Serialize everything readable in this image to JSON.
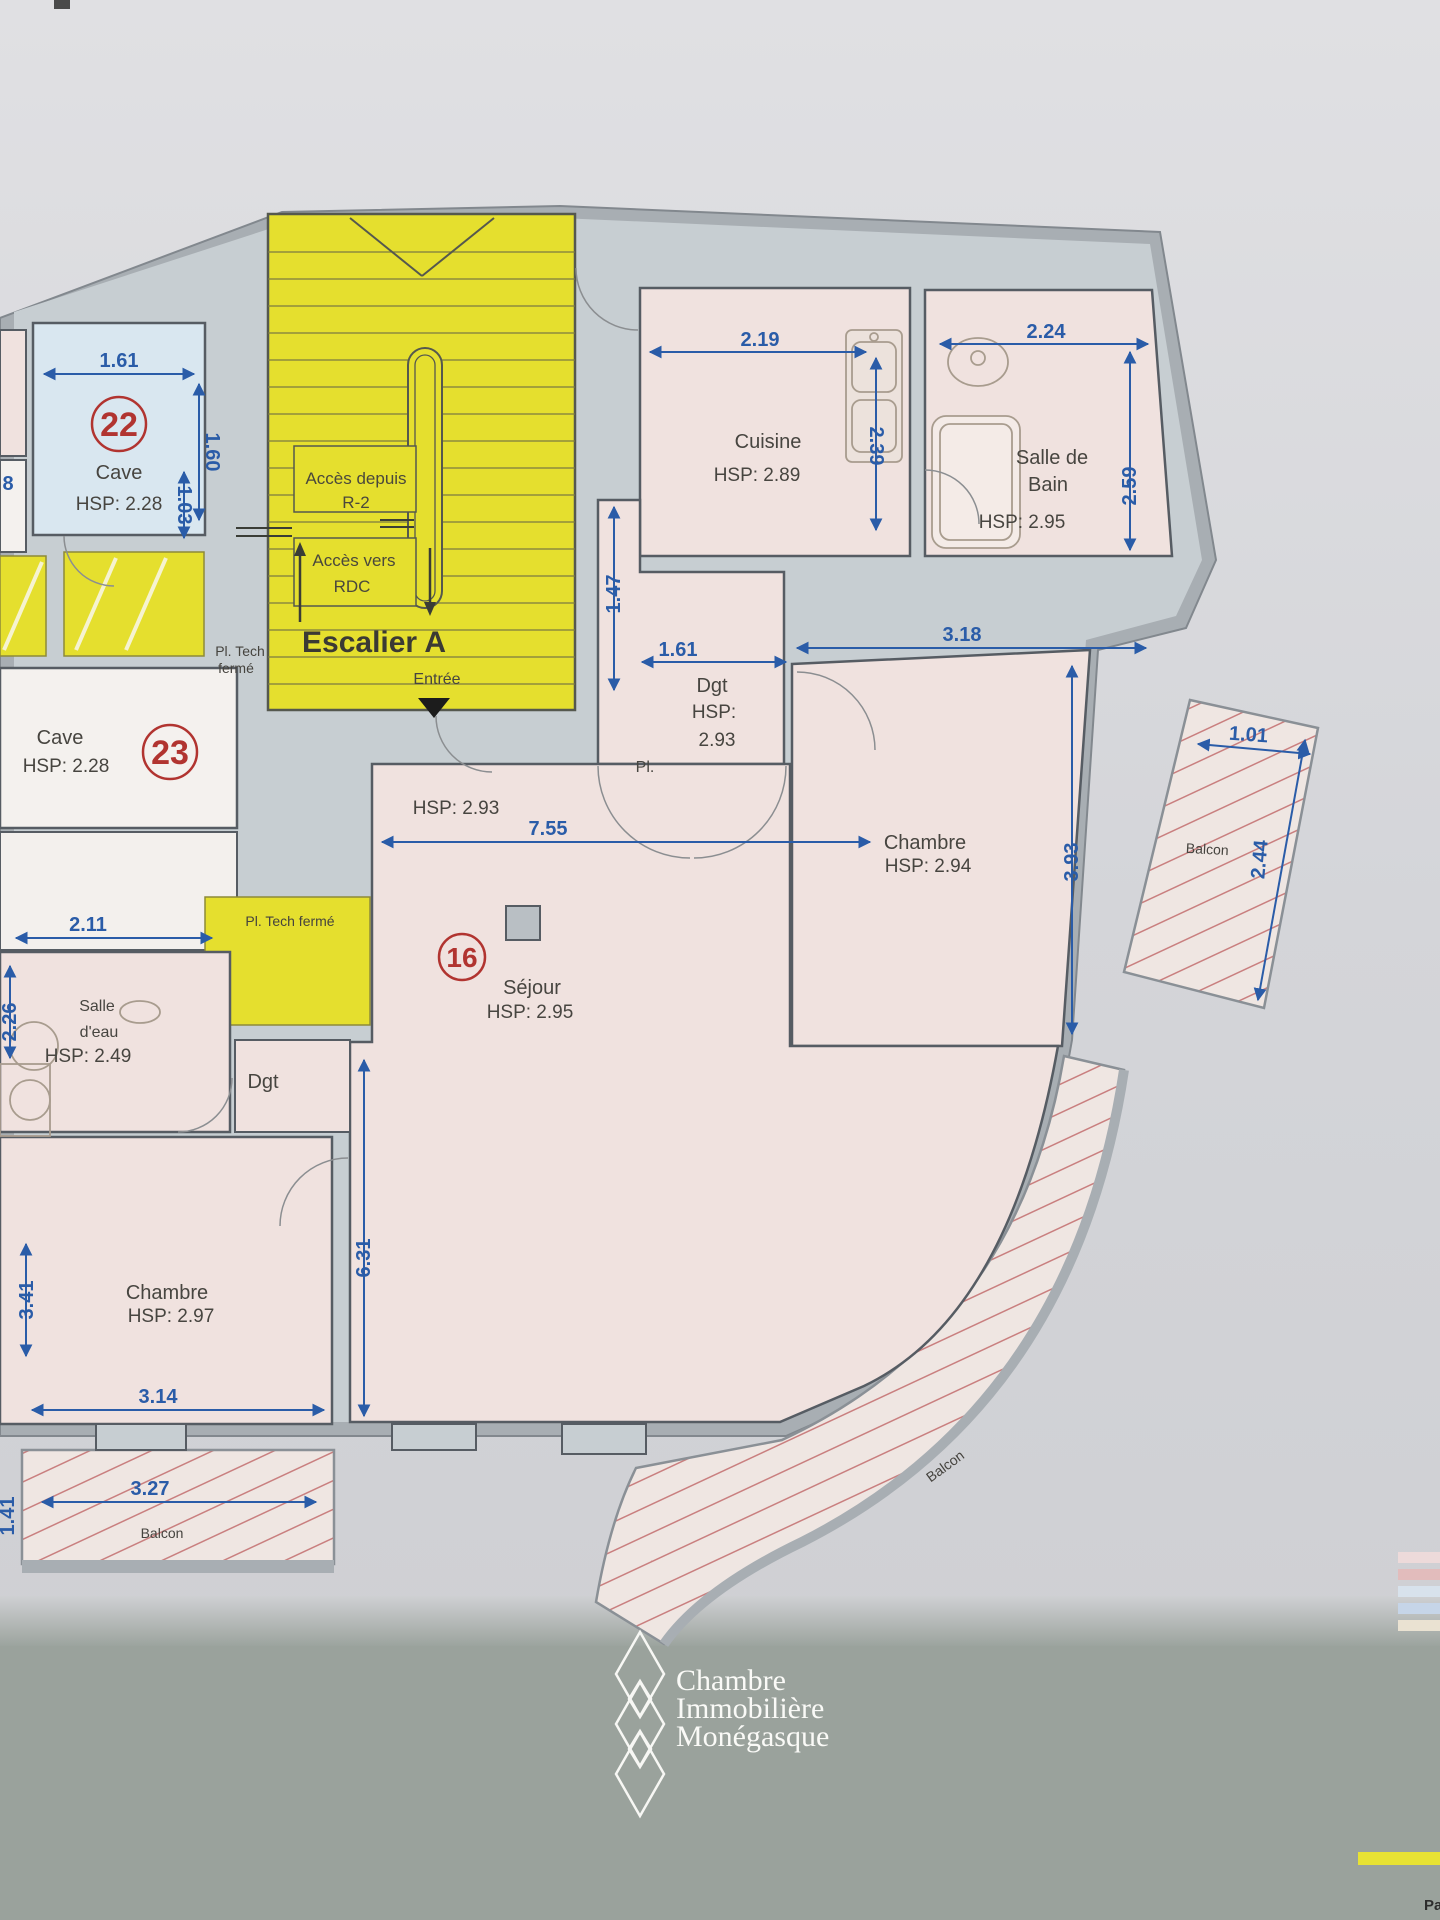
{
  "document_type": "floor-plan-photo",
  "plan": {
    "stairwell": {
      "title": "Escalier A",
      "access_from_line1": "Accès depuis",
      "access_from_line2": "R-2",
      "access_to_line1": "Accès vers",
      "access_to_line2": "RDC",
      "entrance": "Entrée"
    },
    "rooms": {
      "cave22": {
        "number": "22",
        "name": "Cave",
        "hsp": "HSP: 2.28"
      },
      "cave23": {
        "number": "23",
        "name": "Cave",
        "hsp": "HSP: 2.28"
      },
      "cuisine": {
        "name": "Cuisine",
        "hsp": "HSP: 2.89"
      },
      "salle_de_bain": {
        "name_line1": "Salle de",
        "name_line2": "Bain",
        "hsp": "HSP: 2.95"
      },
      "dgt_entry": {
        "name": "Dgt",
        "hsp_line1": "HSP:",
        "hsp_line2": "2.93",
        "closet": "Pl."
      },
      "chambre_ne": {
        "name": "Chambre",
        "hsp": "HSP: 2.94"
      },
      "sejour": {
        "number": "16",
        "name": "Séjour",
        "hsp": "HSP: 2.95",
        "hall_hsp": "HSP: 2.93"
      },
      "salle_eau": {
        "name_line1": "Salle",
        "name_line2": "d'eau",
        "hsp": "HSP: 2.49"
      },
      "dgt_sw": {
        "name": "Dgt"
      },
      "chambre_sw": {
        "name": "Chambre",
        "hsp": "HSP: 2.97"
      },
      "balcon_e": {
        "name": "Balcon"
      },
      "balcon_s": {
        "name": "Balcon"
      },
      "balcon_sw": {
        "name": "Balcon"
      },
      "pl_tech_closed_left": {
        "line1": "Pl. Tech",
        "line2": "fermé"
      },
      "pl_tech_closed_center": {
        "label": "Pl. Tech fermé"
      }
    },
    "dimensions": {
      "cave22_width": "1.61",
      "cave22_height": "1.60",
      "left_edge_partial": "8",
      "cave_side": "1.03",
      "cuisine_width": "2.19",
      "cuisine_height": "2.39",
      "sdb_width": "2.24",
      "sdb_height": "2.59",
      "hall_height": "1.47",
      "hall_width": "1.61",
      "chambre_ne_width": "3.18",
      "chambre_ne_height": "3.93",
      "balcon_e_width": "1.01",
      "balcon_e_height": "2.44",
      "salle_eau_width": "2.11",
      "salle_eau_height": "2.26",
      "sejour_width": "7.55",
      "sejour_height": "6.31",
      "chambre_sw_height": "3.41",
      "chambre_sw_width": "3.14",
      "balcon_sw_width": "3.27",
      "balcon_sw_height": "1.41"
    },
    "colors": {
      "stair_yellow": "#e5df2e",
      "dimension_blue": "#2a5ca8",
      "room_pink": "#f0e2df",
      "cave_blue": "#d9e7f0",
      "wall_gray": "#a8aeb3",
      "corridor_gray": "#c7ced2",
      "number_circle_red": "#b13430",
      "watermark_band": "#9aa29c"
    }
  },
  "watermark": {
    "line1": "Chambre",
    "line2": "Immobilière",
    "line3": "Monégasque"
  },
  "footer": {
    "partial_text": "Pa"
  }
}
